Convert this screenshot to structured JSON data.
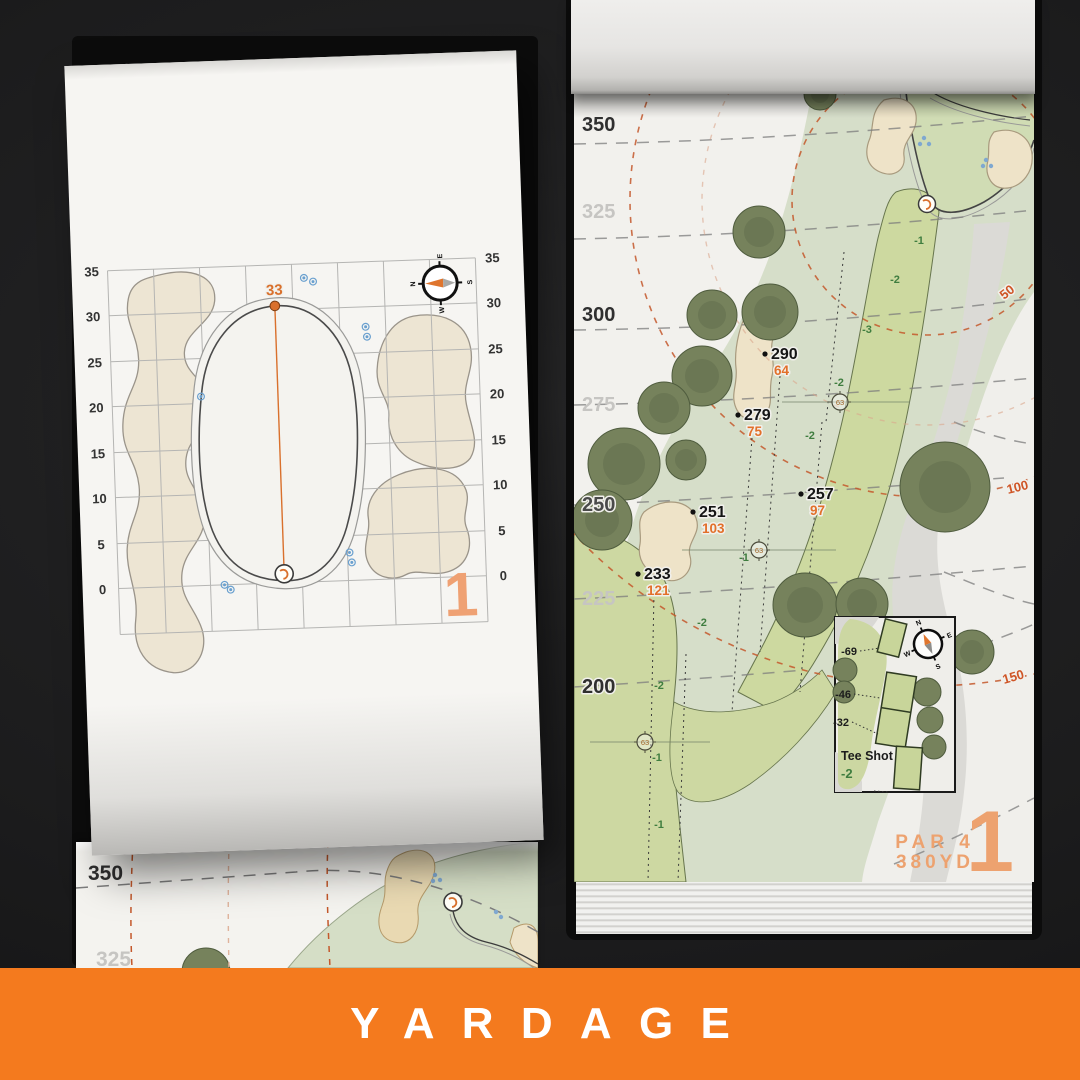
{
  "banner": {
    "label": "YARDAGE",
    "bg_color": "#F47A1E",
    "text_color": "#FFFFFF"
  },
  "colors": {
    "accent_orange": "#E2702A",
    "muted_orange": "#EDA26F",
    "arc_orange": "#C4582B",
    "fairway_green": "#CDD8A2",
    "rough_green": "#D6DEC9",
    "bunker_sand": "#EEE3C8",
    "slope_green": "#3F7D3F",
    "sprinkler_blue": "#6AA0CF"
  },
  "green_page": {
    "axis_left": [
      "35",
      "30",
      "25",
      "20",
      "15",
      "10",
      "5",
      "0"
    ],
    "axis_right": [
      "35",
      "30",
      "25",
      "20",
      "15",
      "10",
      "5",
      "0"
    ],
    "pin_depth": "33",
    "hole_number": "1",
    "compass": {
      "n": "N",
      "e": "E",
      "s": "S",
      "w": "W"
    }
  },
  "hole_page": {
    "distance_ticks": [
      {
        "label": "350",
        "muted": false
      },
      {
        "label": "325",
        "muted": true
      },
      {
        "label": "300",
        "muted": false
      },
      {
        "label": "275",
        "muted": true
      },
      {
        "label": "250",
        "muted": false
      },
      {
        "label": "225",
        "muted": true
      },
      {
        "label": "200",
        "muted": false
      }
    ],
    "carry_points": [
      {
        "to_green": "290",
        "from_tee": "64"
      },
      {
        "to_green": "279",
        "from_tee": "75"
      },
      {
        "to_green": "257",
        "from_tee": "97"
      },
      {
        "to_green": "251",
        "from_tee": "103"
      },
      {
        "to_green": "233",
        "from_tee": "121"
      }
    ],
    "arc_labels": [
      "50",
      "100",
      "150"
    ],
    "sprinklers": [
      "63",
      "63",
      "63"
    ],
    "slopes": [
      "-1",
      "-2",
      "-3",
      "-2",
      "-2",
      "-1",
      "-2",
      "-2",
      "-1",
      "-1"
    ],
    "tee_inset": {
      "title": "Tee Shot",
      "slope": "-2",
      "tee_yardages": [
        "-69",
        "-46",
        "-32"
      ],
      "compass": {
        "n": "N",
        "e": "E",
        "s": "S",
        "w": "W"
      }
    },
    "par_label": "PAR 4",
    "yardage_label": "380YD",
    "hole_number": "1"
  },
  "back_page": {
    "distance_ticks": [
      "350",
      "325"
    ]
  }
}
